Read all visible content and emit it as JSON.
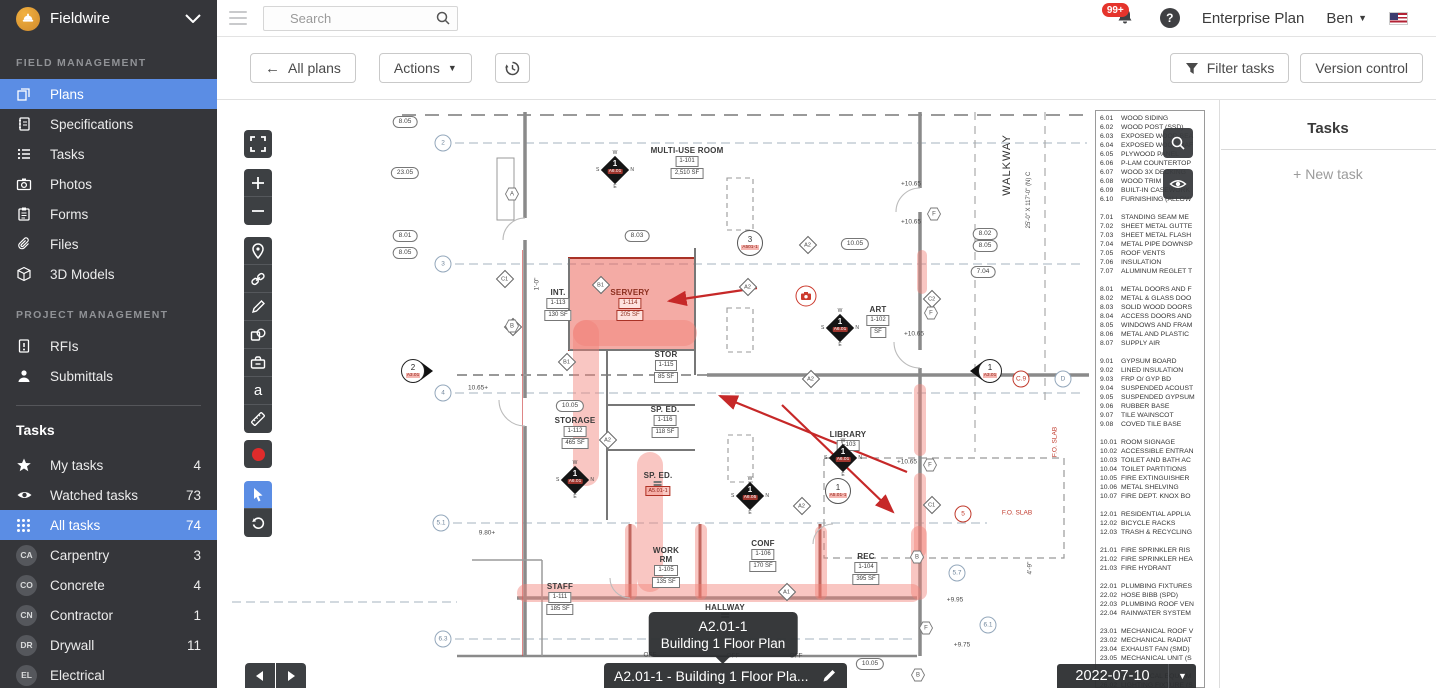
{
  "colors": {
    "accent_blue": "#5b8de4",
    "sidebar_bg": "#35363a",
    "record_red": "#e02b2b",
    "badge_red": "#e5342c",
    "annotation_red": "#c0392b"
  },
  "topbar": {
    "brand": "Fieldwire",
    "search_placeholder": "Search",
    "notification_count": "99+",
    "plan_label": "Enterprise Plan",
    "user": "Ben",
    "icons": [
      "hamburger-icon",
      "search-icon",
      "bell-icon",
      "help-icon",
      "us-flag-icon",
      "chevron-down-icon"
    ]
  },
  "sidebar": {
    "field_heading": "FIELD MANAGEMENT",
    "field_items": [
      {
        "icon": "plans",
        "label": "Plans",
        "selected": true
      },
      {
        "icon": "specifications",
        "label": "Specifications"
      },
      {
        "icon": "tasks",
        "label": "Tasks"
      },
      {
        "icon": "photos",
        "label": "Photos"
      },
      {
        "icon": "forms",
        "label": "Forms"
      },
      {
        "icon": "files",
        "label": "Files"
      },
      {
        "icon": "models",
        "label": "3D Models"
      }
    ],
    "project_heading": "PROJECT MANAGEMENT",
    "project_items": [
      {
        "icon": "rfis",
        "label": "RFIs"
      },
      {
        "icon": "submittals",
        "label": "Submittals"
      }
    ],
    "tasks_heading": "Tasks",
    "task_filters": [
      {
        "icon": "star",
        "label": "My tasks",
        "count": "4"
      },
      {
        "icon": "eye",
        "label": "Watched tasks",
        "count": "73"
      },
      {
        "icon": "grid",
        "label": "All tasks",
        "count": "74",
        "selected": true
      }
    ],
    "task_categories": [
      {
        "badge": "CA",
        "label": "Carpentry",
        "count": "3"
      },
      {
        "badge": "CO",
        "label": "Concrete",
        "count": "4"
      },
      {
        "badge": "CN",
        "label": "Contractor",
        "count": "1"
      },
      {
        "badge": "DR",
        "label": "Drywall",
        "count": "11"
      },
      {
        "badge": "EL",
        "label": "Electrical",
        "count": ""
      }
    ]
  },
  "toolbar": {
    "all_plans": "All plans",
    "actions": "Actions",
    "filter_tasks": "Filter tasks",
    "version_control": "Version control",
    "icons": [
      "back-arrow-icon",
      "dropdown-caret-icon",
      "history-icon",
      "funnel-icon"
    ]
  },
  "plan_viewer": {
    "sheet_tooltip_title": "A2.01-1",
    "sheet_tooltip_subtitle": "Building 1 Floor Plan",
    "sheet_name": "A2.01-1 - Building 1 Floor Pla...",
    "version_date": "2022-07-10",
    "tools": [
      "fullscreen",
      "zoom-in",
      "zoom-out",
      "pin",
      "link",
      "pen",
      "shapes",
      "toolbox",
      "text",
      "ruler",
      "record",
      "cursor",
      "rotate"
    ],
    "legend_buttons": [
      "magnifier-icon",
      "eye-icon"
    ]
  },
  "tasks_panel": {
    "title": "Tasks",
    "new_task": "+ New task"
  },
  "keynotes": [
    {
      "c": "6.01",
      "t": "WOOD SIDING"
    },
    {
      "c": "6.02",
      "t": "WOOD POST (SSD)"
    },
    {
      "c": "6.03",
      "t": "EXPOSED WOOD BEA"
    },
    {
      "c": "6.04",
      "t": "EXPOSED WOOD RAF"
    },
    {
      "c": "6.05",
      "t": "PLYWOOD PANEL"
    },
    {
      "c": "6.06",
      "t": "P-LAM COUNTERTOP"
    },
    {
      "c": "6.07",
      "t": "WOOD 3X DECKING"
    },
    {
      "c": "6.08",
      "t": "WOOD TRIM"
    },
    {
      "c": "6.09",
      "t": "BUILT-IN CASEWORK"
    },
    {
      "c": "6.10",
      "t": "FURNISHING (ALLOW"
    },
    {
      "c": "",
      "t": ""
    },
    {
      "c": "7.01",
      "t": "STANDING SEAM ME"
    },
    {
      "c": "7.02",
      "t": "SHEET METAL GUTTE"
    },
    {
      "c": "7.03",
      "t": "SHEET METAL FLASH"
    },
    {
      "c": "7.04",
      "t": "METAL PIPE DOWNSP"
    },
    {
      "c": "7.05",
      "t": "ROOF VENTS"
    },
    {
      "c": "7.06",
      "t": "INSULATION"
    },
    {
      "c": "7.07",
      "t": "ALUMINUM REGLET T"
    },
    {
      "c": "",
      "t": ""
    },
    {
      "c": "8.01",
      "t": "METAL DOORS AND F"
    },
    {
      "c": "8.02",
      "t": "METAL & GLASS DOO"
    },
    {
      "c": "8.03",
      "t": "SOLID WOOD DOORS"
    },
    {
      "c": "8.04",
      "t": "ACCESS DOORS AND"
    },
    {
      "c": "8.05",
      "t": "WINDOWS AND FRAM"
    },
    {
      "c": "8.06",
      "t": "METAL AND PLASTIC"
    },
    {
      "c": "8.07",
      "t": "SUPPLY AIR"
    },
    {
      "c": "",
      "t": ""
    },
    {
      "c": "9.01",
      "t": "GYPSUM BOARD"
    },
    {
      "c": "9.02",
      "t": "LINED INSULATION"
    },
    {
      "c": "9.03",
      "t": "FRP O/ GYP BD"
    },
    {
      "c": "9.04",
      "t": "SUSPENDED ACOUST"
    },
    {
      "c": "9.05",
      "t": "SUSPENDED GYPSUM"
    },
    {
      "c": "9.06",
      "t": "RUBBER BASE"
    },
    {
      "c": "9.07",
      "t": "TILE WAINSCOT"
    },
    {
      "c": "9.08",
      "t": "COVED TILE BASE"
    },
    {
      "c": "",
      "t": ""
    },
    {
      "c": "10.01",
      "t": "ROOM SIGNAGE"
    },
    {
      "c": "10.02",
      "t": "ACCESSIBLE ENTRAN"
    },
    {
      "c": "10.03",
      "t": "TOILET AND BATH AC"
    },
    {
      "c": "10.04",
      "t": "TOILET PARTITIONS"
    },
    {
      "c": "10.05",
      "t": "FIRE EXTINGUISHER"
    },
    {
      "c": "10.06",
      "t": "METAL SHELVING"
    },
    {
      "c": "10.07",
      "t": "FIRE DEPT. KNOX BO"
    },
    {
      "c": "",
      "t": ""
    },
    {
      "c": "12.01",
      "t": "RESIDENTIAL APPLIA"
    },
    {
      "c": "12.02",
      "t": "BICYCLE RACKS"
    },
    {
      "c": "12.03",
      "t": "TRASH & RECYCLING"
    },
    {
      "c": "",
      "t": ""
    },
    {
      "c": "21.01",
      "t": "FIRE SPRINKLER RIS"
    },
    {
      "c": "21.02",
      "t": "FIRE SPRINKLER HEA"
    },
    {
      "c": "21.03",
      "t": "FIRE HYDRANT"
    },
    {
      "c": "",
      "t": ""
    },
    {
      "c": "22.01",
      "t": "PLUMBING FIXTURES"
    },
    {
      "c": "22.02",
      "t": "HOSE BIBB (SPD)"
    },
    {
      "c": "22.03",
      "t": "PLUMBING ROOF VEN"
    },
    {
      "c": "22.04",
      "t": "RAINWATER SYSTEM"
    },
    {
      "c": "",
      "t": ""
    },
    {
      "c": "23.01",
      "t": "MECHANICAL ROOF V"
    },
    {
      "c": "23.02",
      "t": "MECHANICAL RADIAT"
    },
    {
      "c": "23.04",
      "t": "EXHAUST FAN (SMD)"
    },
    {
      "c": "23.05",
      "t": "MECHANICAL UNIT (S"
    },
    {
      "c": "",
      "t": ""
    },
    {
      "c": "26.01",
      "t": "ELECTRICAL EQUIPM"
    },
    {
      "c": "26.02",
      "t": "LIGHTING FIXTURE (S"
    }
  ],
  "floor_plan": {
    "rooms": [
      {
        "x": 470,
        "y": 46,
        "label": "MULTI-USE ROOM",
        "tag": "1-101",
        "sf": "2,510 SF"
      },
      {
        "x": 413,
        "y": 188,
        "label": "SERVERY",
        "tag": "1-114",
        "sf": "205 SF",
        "cls": "red-room"
      },
      {
        "x": 341,
        "y": 188,
        "label": "INT.",
        "tag": "1-113",
        "sf": "130 SF"
      },
      {
        "x": 449,
        "y": 250,
        "label": "STOR",
        "tag": "1-115",
        "sf": "85 SF"
      },
      {
        "x": 358,
        "y": 316,
        "label": "STORAGE",
        "tag": "1-112",
        "sf": "465 SF"
      },
      {
        "x": 448,
        "y": 305,
        "label": "SP. ED.",
        "tag": "1-116",
        "sf": "118 SF"
      },
      {
        "x": 441,
        "y": 371,
        "label": "SP. ED.",
        "tag": "",
        "sf": ""
      },
      {
        "x": 631,
        "y": 330,
        "label": "LIBRARY",
        "tag": "1-103",
        "sf": ""
      },
      {
        "x": 661,
        "y": 205,
        "label": "ART",
        "tag": "1-102",
        "sf": "SF"
      },
      {
        "x": 449,
        "y": 447,
        "label": "WORK RM",
        "tag": "1-105",
        "sf": "135 SF",
        "cls": "narrow"
      },
      {
        "x": 546,
        "y": 439,
        "label": "CONF",
        "tag": "1-106",
        "sf": "170 SF"
      },
      {
        "x": 649,
        "y": 452,
        "label": "REC",
        "tag": "1-104",
        "sf": "395 SF"
      },
      {
        "x": 343,
        "y": 482,
        "label": "STAFF",
        "tag": "1-111",
        "sf": "185 SF"
      },
      {
        "x": 508,
        "y": 503,
        "label": "HALLWAY",
        "tag": "",
        "sf": ""
      }
    ],
    "ovals": [
      {
        "x": 188,
        "y": 22,
        "t": "8.05"
      },
      {
        "x": 188,
        "y": 73,
        "t": "23.05"
      },
      {
        "x": 188,
        "y": 136,
        "t": "8.01"
      },
      {
        "x": 188,
        "y": 153,
        "t": "8.05"
      },
      {
        "x": 420,
        "y": 136,
        "t": "8.03"
      },
      {
        "x": 638,
        "y": 144,
        "t": "10.05"
      },
      {
        "x": 768,
        "y": 134,
        "t": "8.02"
      },
      {
        "x": 768,
        "y": 146,
        "t": "8.05"
      },
      {
        "x": 766,
        "y": 172,
        "t": "7.04"
      },
      {
        "x": 353,
        "y": 306,
        "t": "10.05"
      },
      {
        "x": 653,
        "y": 564,
        "t": "10.05"
      }
    ],
    "grid_circles": [
      {
        "x": 226,
        "y": 43,
        "t": "2"
      },
      {
        "x": 226,
        "y": 164,
        "t": "3"
      },
      {
        "x": 226,
        "y": 293,
        "t": "4"
      },
      {
        "x": 224,
        "y": 423,
        "t": "5.1"
      },
      {
        "x": 226,
        "y": 539,
        "t": "6.3"
      },
      {
        "x": 804,
        "y": 279,
        "t": "C.9",
        "cls": "red"
      },
      {
        "x": 846,
        "y": 279,
        "t": "D"
      },
      {
        "x": 740,
        "y": 473,
        "t": "5.7"
      },
      {
        "x": 771,
        "y": 525,
        "t": "6.1"
      },
      {
        "x": 746,
        "y": 414,
        "t": "5",
        "cls": "red"
      }
    ],
    "ref_diamonds": [
      {
        "x": 591,
        "y": 145,
        "t": "A2"
      },
      {
        "x": 531,
        "y": 187,
        "t": "A2"
      },
      {
        "x": 594,
        "y": 279,
        "t": "A2"
      },
      {
        "x": 391,
        "y": 340,
        "t": "A2"
      },
      {
        "x": 585,
        "y": 406,
        "t": "A2"
      },
      {
        "x": 384,
        "y": 185,
        "t": "B1"
      },
      {
        "x": 350,
        "y": 262,
        "t": "B1"
      },
      {
        "x": 296,
        "y": 227,
        "t": "B1"
      },
      {
        "x": 288,
        "y": 179,
        "t": "C1"
      },
      {
        "x": 715,
        "y": 405,
        "t": "C1"
      },
      {
        "x": 715,
        "y": 199,
        "t": "C2"
      },
      {
        "x": 570,
        "y": 492,
        "t": "A1"
      }
    ],
    "hexagons": [
      {
        "x": 295,
        "y": 94,
        "t": "A"
      },
      {
        "x": 295,
        "y": 226,
        "t": "B"
      },
      {
        "x": 717,
        "y": 114,
        "t": "F"
      },
      {
        "x": 714,
        "y": 213,
        "t": "F"
      },
      {
        "x": 713,
        "y": 365,
        "t": "F"
      },
      {
        "x": 709,
        "y": 528,
        "t": "F"
      },
      {
        "x": 700,
        "y": 457,
        "t": "B"
      },
      {
        "x": 701,
        "y": 575,
        "t": "B"
      }
    ],
    "compass_markers": [
      {
        "x": 398,
        "y": 70,
        "num": "1",
        "sheet": "A6.01"
      },
      {
        "x": 623,
        "y": 228,
        "num": "1",
        "sheet": "A6.01"
      },
      {
        "x": 358,
        "y": 380,
        "num": "1",
        "sheet": "A6.01"
      },
      {
        "x": 626,
        "y": 358,
        "num": "1",
        "sheet": "A6.01"
      },
      {
        "x": 533,
        "y": 396,
        "num": "1",
        "sheet": "A6.05"
      }
    ],
    "section_markers": [
      {
        "x": 196,
        "y": 271,
        "num": "2",
        "sheet": "A3.01",
        "dir": "right"
      },
      {
        "x": 773,
        "y": 271,
        "num": "1",
        "sheet": "A3.01",
        "dir": "left"
      }
    ],
    "circle_markers": [
      {
        "x": 533,
        "y": 143,
        "num": "3",
        "sheet": "A501-1"
      },
      {
        "x": 621,
        "y": 391,
        "num": "1",
        "sheet": "A5.01-1"
      }
    ],
    "red_tags": [
      {
        "x": 441,
        "y": 391,
        "t": "A5.01-1"
      }
    ],
    "texts": [
      {
        "x": 694,
        "y": 84,
        "t": "+10.65"
      },
      {
        "x": 694,
        "y": 122,
        "t": "+10.65"
      },
      {
        "x": 697,
        "y": 234,
        "t": "+10.65"
      },
      {
        "x": 690,
        "y": 362,
        "t": "+10.65"
      },
      {
        "x": 738,
        "y": 500,
        "t": "+9.95"
      },
      {
        "x": 745,
        "y": 545,
        "t": "+9.75"
      },
      {
        "x": 261,
        "y": 288,
        "t": "10.65+"
      },
      {
        "x": 270,
        "y": 433,
        "t": "9.80+"
      },
      {
        "x": 320,
        "y": 184,
        "t": "1'-0\"",
        "cls": "vert"
      },
      {
        "x": 813,
        "y": 468,
        "t": "4'-9\"",
        "cls": "vert"
      },
      {
        "x": 790,
        "y": 65,
        "t": "WALKWAY",
        "cls": "vert big"
      },
      {
        "x": 812,
        "y": 100,
        "t": "25'-0\" X 117'-0\" (N) C",
        "cls": "vert tiny"
      },
      {
        "x": 838,
        "y": 342,
        "t": "F.O. SLAB",
        "cls": "vert red"
      },
      {
        "x": 800,
        "y": 413,
        "t": "F.O. SLAB",
        "cls": "red"
      },
      {
        "x": 433,
        "y": 555,
        "t": "OFF"
      },
      {
        "x": 516,
        "y": 556,
        "t": "OFF"
      },
      {
        "x": 579,
        "y": 556,
        "t": "OFF"
      }
    ],
    "photo_markers": [
      {
        "x": 589,
        "y": 196
      }
    ]
  }
}
